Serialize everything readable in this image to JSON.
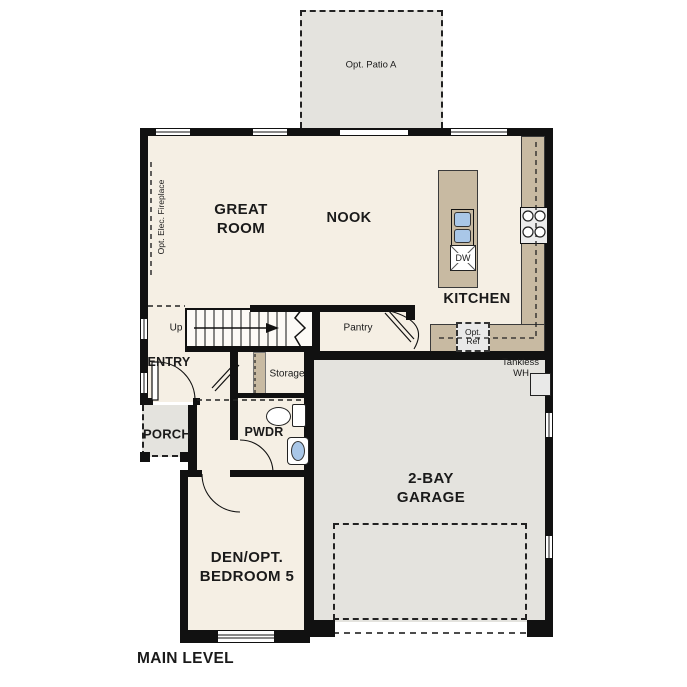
{
  "title": "MAIN LEVEL",
  "labels": {
    "patio": "Opt. Patio A",
    "great_room_1": "GREAT",
    "great_room_2": "ROOM",
    "nook": "NOOK",
    "kitchen": "KITCHEN",
    "pantry": "Pantry",
    "up": "Up",
    "storage": "Storage",
    "entry": "ENTRY",
    "porch": "PORCH",
    "pwdr": "PWDR",
    "garage_1": "2-BAY",
    "garage_2": "GARAGE",
    "den_1": "DEN/OPT.",
    "den_2": "BEDROOM 5",
    "dw": "DW",
    "opt_ref_1": "Opt.",
    "opt_ref_2": "Ref",
    "tankless_1": "Tankless",
    "tankless_2": "WH",
    "fireplace": "Opt. Elec. Fireplace"
  },
  "colors": {
    "floor": "#f5efe4",
    "counter": "#c8baa2",
    "exterior_area": "#e4e3de",
    "appliance": "#ececec",
    "sink": "#a9c7e8",
    "wall": "#111111"
  }
}
